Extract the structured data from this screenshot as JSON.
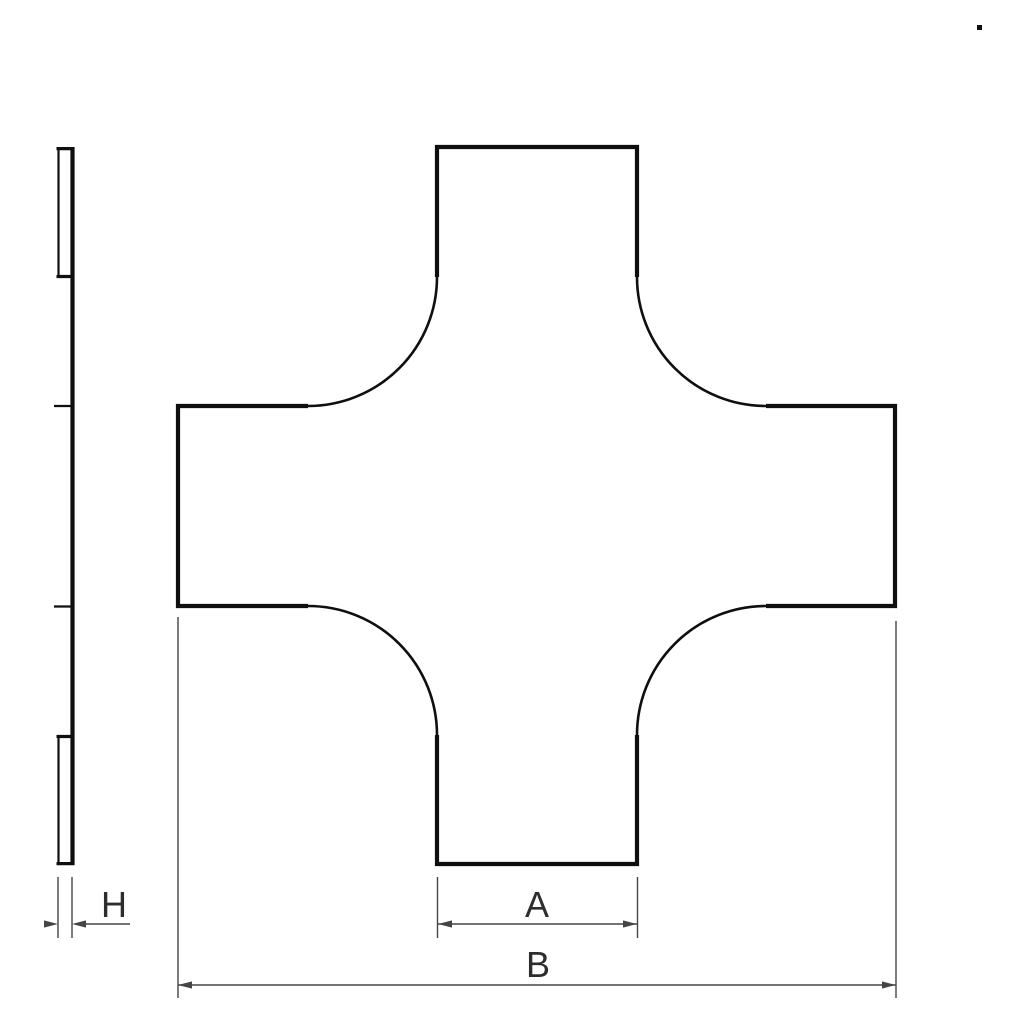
{
  "diagram": {
    "colors": {
      "outline": "#0f0f0f",
      "dimension": "#454545",
      "label_text": "#2d2d2d",
      "background": "#ffffff"
    },
    "dimensions": {
      "h": {
        "label": "H"
      },
      "a": {
        "label": "A"
      },
      "b": {
        "label": "B"
      }
    }
  }
}
